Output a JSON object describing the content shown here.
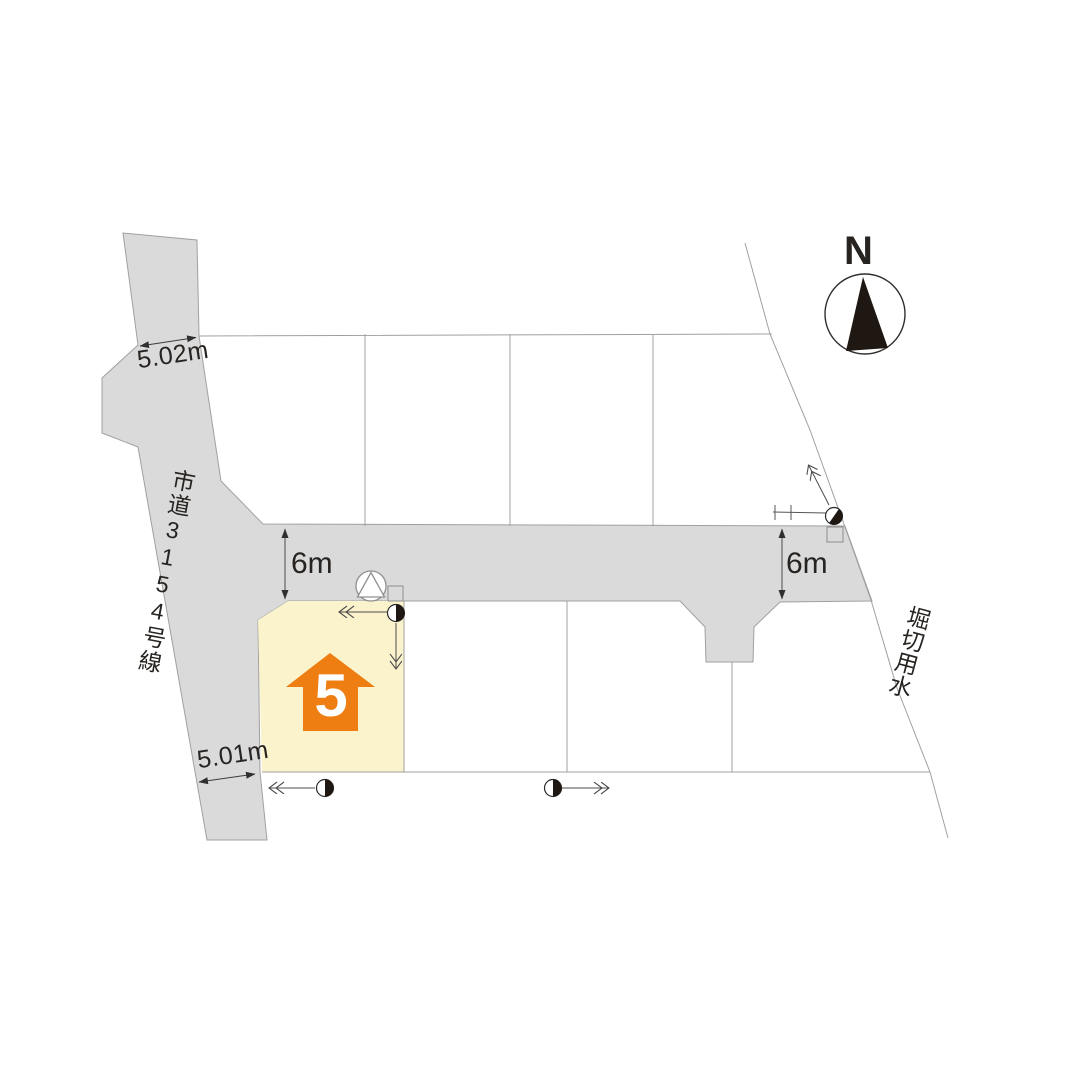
{
  "north_indicator": {
    "label": "N"
  },
  "roads": {
    "vertical_road": {
      "name": "市道3154号線",
      "width_top": "5.02m",
      "width_bottom": "5.01m"
    },
    "horizontal_road": {
      "width_west": "6m",
      "width_east": "6m"
    }
  },
  "waterway": {
    "name": "堀切用水"
  },
  "highlighted_lot": {
    "number": "5"
  },
  "colors": {
    "road": "#dadada",
    "lot_highlight": "#faf3cc",
    "house_arrow": "#ee7e11",
    "boundary_line": "#a0a0a0",
    "dimension_line": "#3c3c3c",
    "symbol_black": "#1f1712"
  },
  "symbols": {
    "north_arrow": "compass-needle-in-circle",
    "utility_pole": "half-filled-circle",
    "inspection_chamber": "triangle-in-circle",
    "catch_basin": "small-square"
  }
}
